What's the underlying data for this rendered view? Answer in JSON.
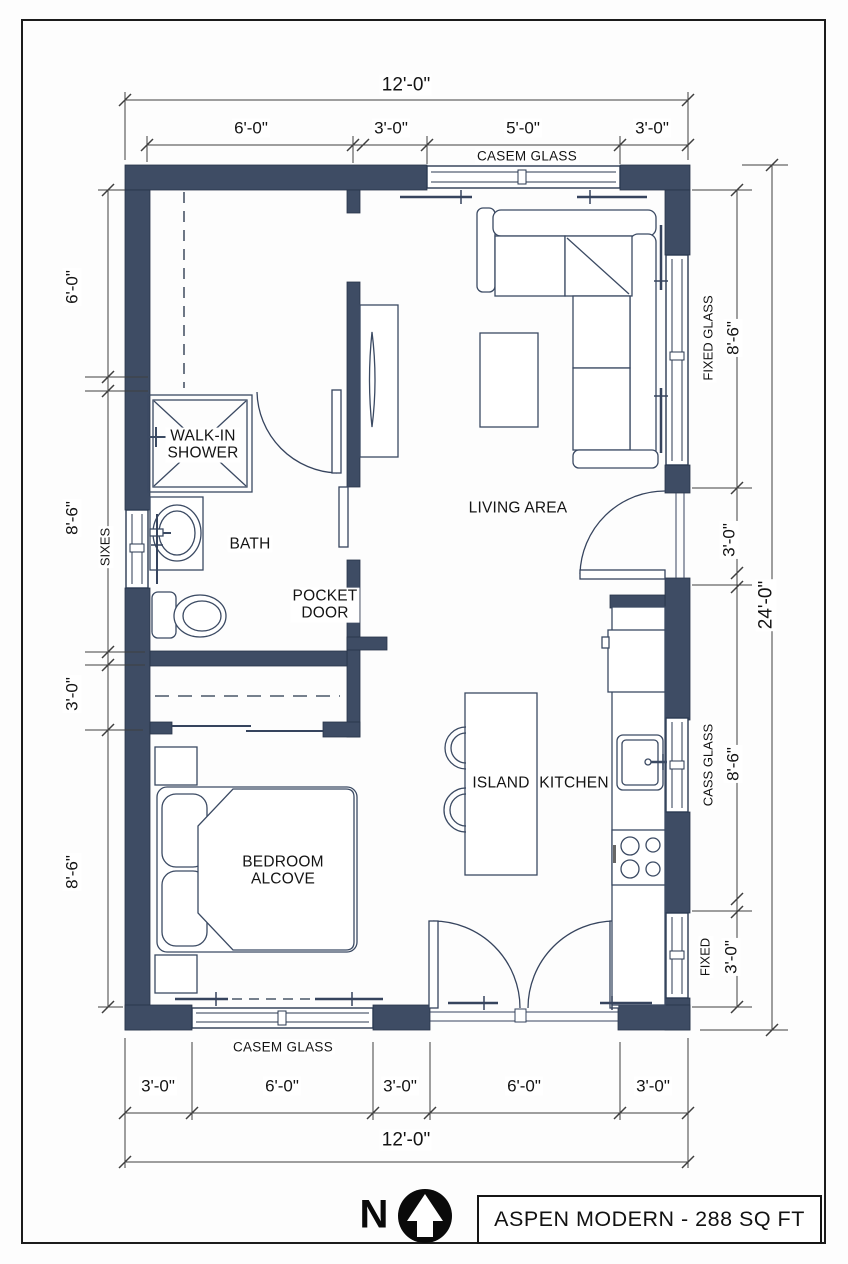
{
  "title_block": {
    "north_label": "N",
    "title": "ASPEN MODERN - 288 SQ FT"
  },
  "rooms": {
    "walk_in_shower": {
      "line1": "WALK-IN",
      "line2": "SHOWER"
    },
    "bath": "BATH",
    "pocket_door": {
      "line1": "POCKET",
      "line2": "DOOR"
    },
    "living_area": "LIVING AREA",
    "island": "ISLAND",
    "kitchen": "KITCHEN",
    "bedroom_alcove": {
      "line1": "BEDROOM",
      "line2": "ALCOVE"
    }
  },
  "dimensions": {
    "top": {
      "overall": "12'-0\"",
      "segments": [
        "6'-0\"",
        "3'-0\"",
        "5'-0\"",
        "3'-0\""
      ],
      "window_label": "CASEM GLASS"
    },
    "bottom": {
      "overall": "12'-0\"",
      "segments": [
        "3'-0\"",
        "6'-0\"",
        "3'-0\"",
        "6'-0\"",
        "3'-0\""
      ],
      "window_label": "CASEM GLASS"
    },
    "left": {
      "segments": [
        "6'-0\"",
        "8'-6\"",
        "3'-0\"",
        "8'-6\""
      ],
      "window_label": "SIXES"
    },
    "right": {
      "overall": "24'-0\"",
      "fixed_glass_label": "FIXED GLASS",
      "fixed_glass_value": "8'-6\"",
      "door_value": "3'-0\"",
      "cass_glass_label": "CASS GLASS",
      "cass_glass_value": "8'-6\"",
      "fixed_label": "FIXED",
      "fixed_value": "3'-0\""
    }
  },
  "colors": {
    "wall": "#3e4c64",
    "outline": "#36445e",
    "dimension_line": "#3f3f3f",
    "text": "#141414"
  }
}
